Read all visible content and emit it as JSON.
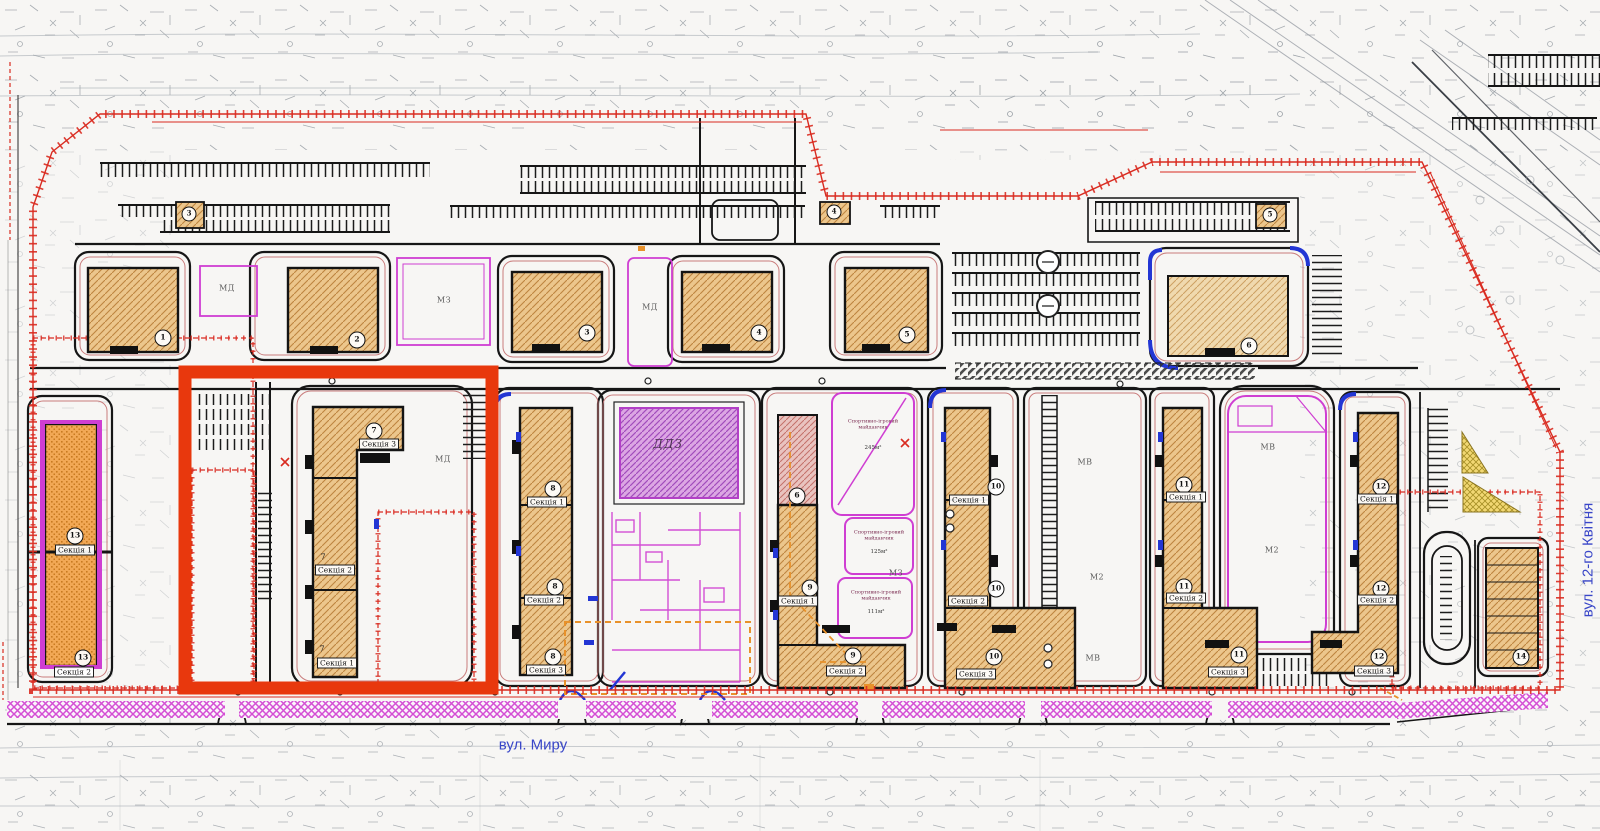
{
  "plan": {
    "streets": {
      "bottom": "вул. Миру",
      "right": "вул. 12-го Квітня"
    },
    "facilities": {
      "kindergarten": "ДДЗ"
    },
    "zones": {
      "md": "МД",
      "mz": "МЗ",
      "mv": "МВ",
      "m2": "М2"
    },
    "buildings": {
      "top_row": [
        {
          "number": "1"
        },
        {
          "number": "2"
        },
        {
          "number": "3"
        },
        {
          "number": "4"
        },
        {
          "number": "5"
        },
        {
          "number": "6"
        }
      ],
      "mid": [
        {
          "number": "7",
          "sections": [
            "Секція 3",
            "Секція 2",
            "Секція 1"
          ],
          "highlighted": true
        },
        {
          "number": "8",
          "sections": [
            "Секція 1",
            "Секція 2",
            "Секція 3"
          ]
        },
        {
          "number": "9",
          "annex": "6",
          "sections": [
            "Секція 1",
            "Секція 2"
          ]
        },
        {
          "number": "10",
          "sections": [
            "Секція 1",
            "Секція 2",
            "Секція 3"
          ]
        },
        {
          "number": "11",
          "sections": [
            "Секція 1",
            "Секція 2",
            "Секція 3"
          ]
        },
        {
          "number": "12",
          "sections": [
            "Секція 1",
            "Секція 2",
            "Секція 3"
          ]
        },
        {
          "number": "13",
          "sections": [
            "Секція 1",
            "Секція 2"
          ]
        },
        {
          "number": "14",
          "sections": []
        }
      ]
    },
    "playgrounds": [
      {
        "label": "Спортивно-ігровий майданчик",
        "area": "245м²"
      },
      {
        "label": "Спортивно-ігровий майданчик",
        "area": "125м²"
      },
      {
        "label": "Спортивно-ігровий майданчик",
        "area": "111м²"
      }
    ],
    "substations": [
      "3",
      "4",
      "5"
    ],
    "colors": {
      "highlight": "#e8380d",
      "boundary": "#d92b20",
      "building_fill": "#ecc68c",
      "building_hatch": "#bd8440",
      "kindergarten": "#dca6e3",
      "magenta": "#cf3ed2",
      "street_text": "#3946c8",
      "yellow": "#f2d873"
    }
  }
}
